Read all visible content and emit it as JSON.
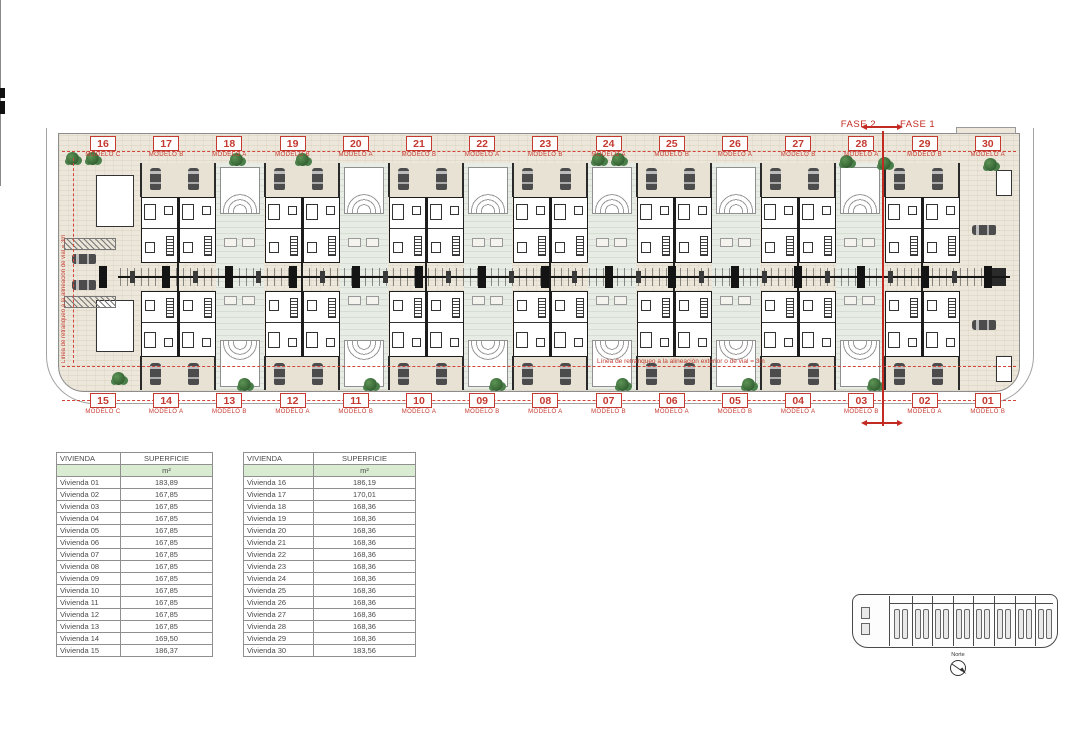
{
  "phase": {
    "fase2_label": "FASE 2",
    "fase1_label": "FASE 1"
  },
  "annotations": {
    "setback_line_horizontal": "Línea de retranqueo a la alineación exterior o de vial = 3m",
    "setback_line_vertical": "Línea de retranqueo a la alineación de vial = 3m"
  },
  "site_plan": {
    "top_units": [
      {
        "num": "16",
        "model": "MODELO C"
      },
      {
        "num": "17",
        "model": "MODELO B"
      },
      {
        "num": "18",
        "model": "MODELO A"
      },
      {
        "num": "19",
        "model": "MODELO B"
      },
      {
        "num": "20",
        "model": "MODELO A"
      },
      {
        "num": "21",
        "model": "MODELO B"
      },
      {
        "num": "22",
        "model": "MODELO A"
      },
      {
        "num": "23",
        "model": "MODELO B"
      },
      {
        "num": "24",
        "model": "MODELO A"
      },
      {
        "num": "25",
        "model": "MODELO B"
      },
      {
        "num": "26",
        "model": "MODELO A"
      },
      {
        "num": "27",
        "model": "MODELO B"
      },
      {
        "num": "28",
        "model": "MODELO A"
      },
      {
        "num": "29",
        "model": "MODELO B"
      },
      {
        "num": "30",
        "model": "MODELO A"
      }
    ],
    "bottom_units": [
      {
        "num": "15",
        "model": "MODELO C"
      },
      {
        "num": "14",
        "model": "MODELO A"
      },
      {
        "num": "13",
        "model": "MODELO B"
      },
      {
        "num": "12",
        "model": "MODELO A"
      },
      {
        "num": "11",
        "model": "MODELO B"
      },
      {
        "num": "10",
        "model": "MODELO A"
      },
      {
        "num": "09",
        "model": "MODELO B"
      },
      {
        "num": "08",
        "model": "MODELO A"
      },
      {
        "num": "07",
        "model": "MODELO B"
      },
      {
        "num": "06",
        "model": "MODELO A"
      },
      {
        "num": "05",
        "model": "MODELO B"
      },
      {
        "num": "04",
        "model": "MODELO A"
      },
      {
        "num": "03",
        "model": "MODELO B"
      },
      {
        "num": "02",
        "model": "MODELO A"
      },
      {
        "num": "01",
        "model": "MODELO B"
      }
    ]
  },
  "tables": [
    {
      "name": "viviendas-01-15",
      "headers": [
        "VIVIENDA",
        "SUPERFICIE"
      ],
      "unit_label": "m²",
      "rows": [
        [
          "Vivienda 01",
          "183,89"
        ],
        [
          "Vivienda 02",
          "167,85"
        ],
        [
          "Vivienda 03",
          "167,85"
        ],
        [
          "Vivienda 04",
          "167,85"
        ],
        [
          "Vivienda 05",
          "167,85"
        ],
        [
          "Vivienda 06",
          "167,85"
        ],
        [
          "Vivienda 07",
          "167,85"
        ],
        [
          "Vivienda 08",
          "167,85"
        ],
        [
          "Vivienda 09",
          "167,85"
        ],
        [
          "Vivienda 10",
          "167,85"
        ],
        [
          "Vivienda 11",
          "167,85"
        ],
        [
          "Vivienda 12",
          "167,85"
        ],
        [
          "Vivienda 13",
          "167,85"
        ],
        [
          "Vivienda 14",
          "169,50"
        ],
        [
          "Vivienda 15",
          "186,37"
        ]
      ]
    },
    {
      "name": "viviendas-16-30",
      "headers": [
        "VIVIENDA",
        "SUPERFICIE"
      ],
      "unit_label": "m²",
      "rows": [
        [
          "Vivienda 16",
          "186,19"
        ],
        [
          "Vivienda 17",
          "170,01"
        ],
        [
          "Vivienda 18",
          "168,36"
        ],
        [
          "Vivienda 19",
          "168,36"
        ],
        [
          "Vivienda 20",
          "168,36"
        ],
        [
          "Vivienda 21",
          "168,36"
        ],
        [
          "Vivienda 22",
          "168,36"
        ],
        [
          "Vivienda 23",
          "168,36"
        ],
        [
          "Vivienda 24",
          "168,36"
        ],
        [
          "Vivienda 25",
          "168,36"
        ],
        [
          "Vivienda 26",
          "168,36"
        ],
        [
          "Vivienda 27",
          "168,36"
        ],
        [
          "Vivienda 28",
          "168,36"
        ],
        [
          "Vivienda 29",
          "168,36"
        ],
        [
          "Vivienda 30",
          "183,56"
        ]
      ]
    }
  ],
  "compass": {
    "label": "Norte"
  },
  "colors": {
    "accent_red": "#c43a30",
    "plot_beige": "#ece7da",
    "patio_green": "#e7ece4",
    "table_header_green": "#d9ecd2"
  }
}
